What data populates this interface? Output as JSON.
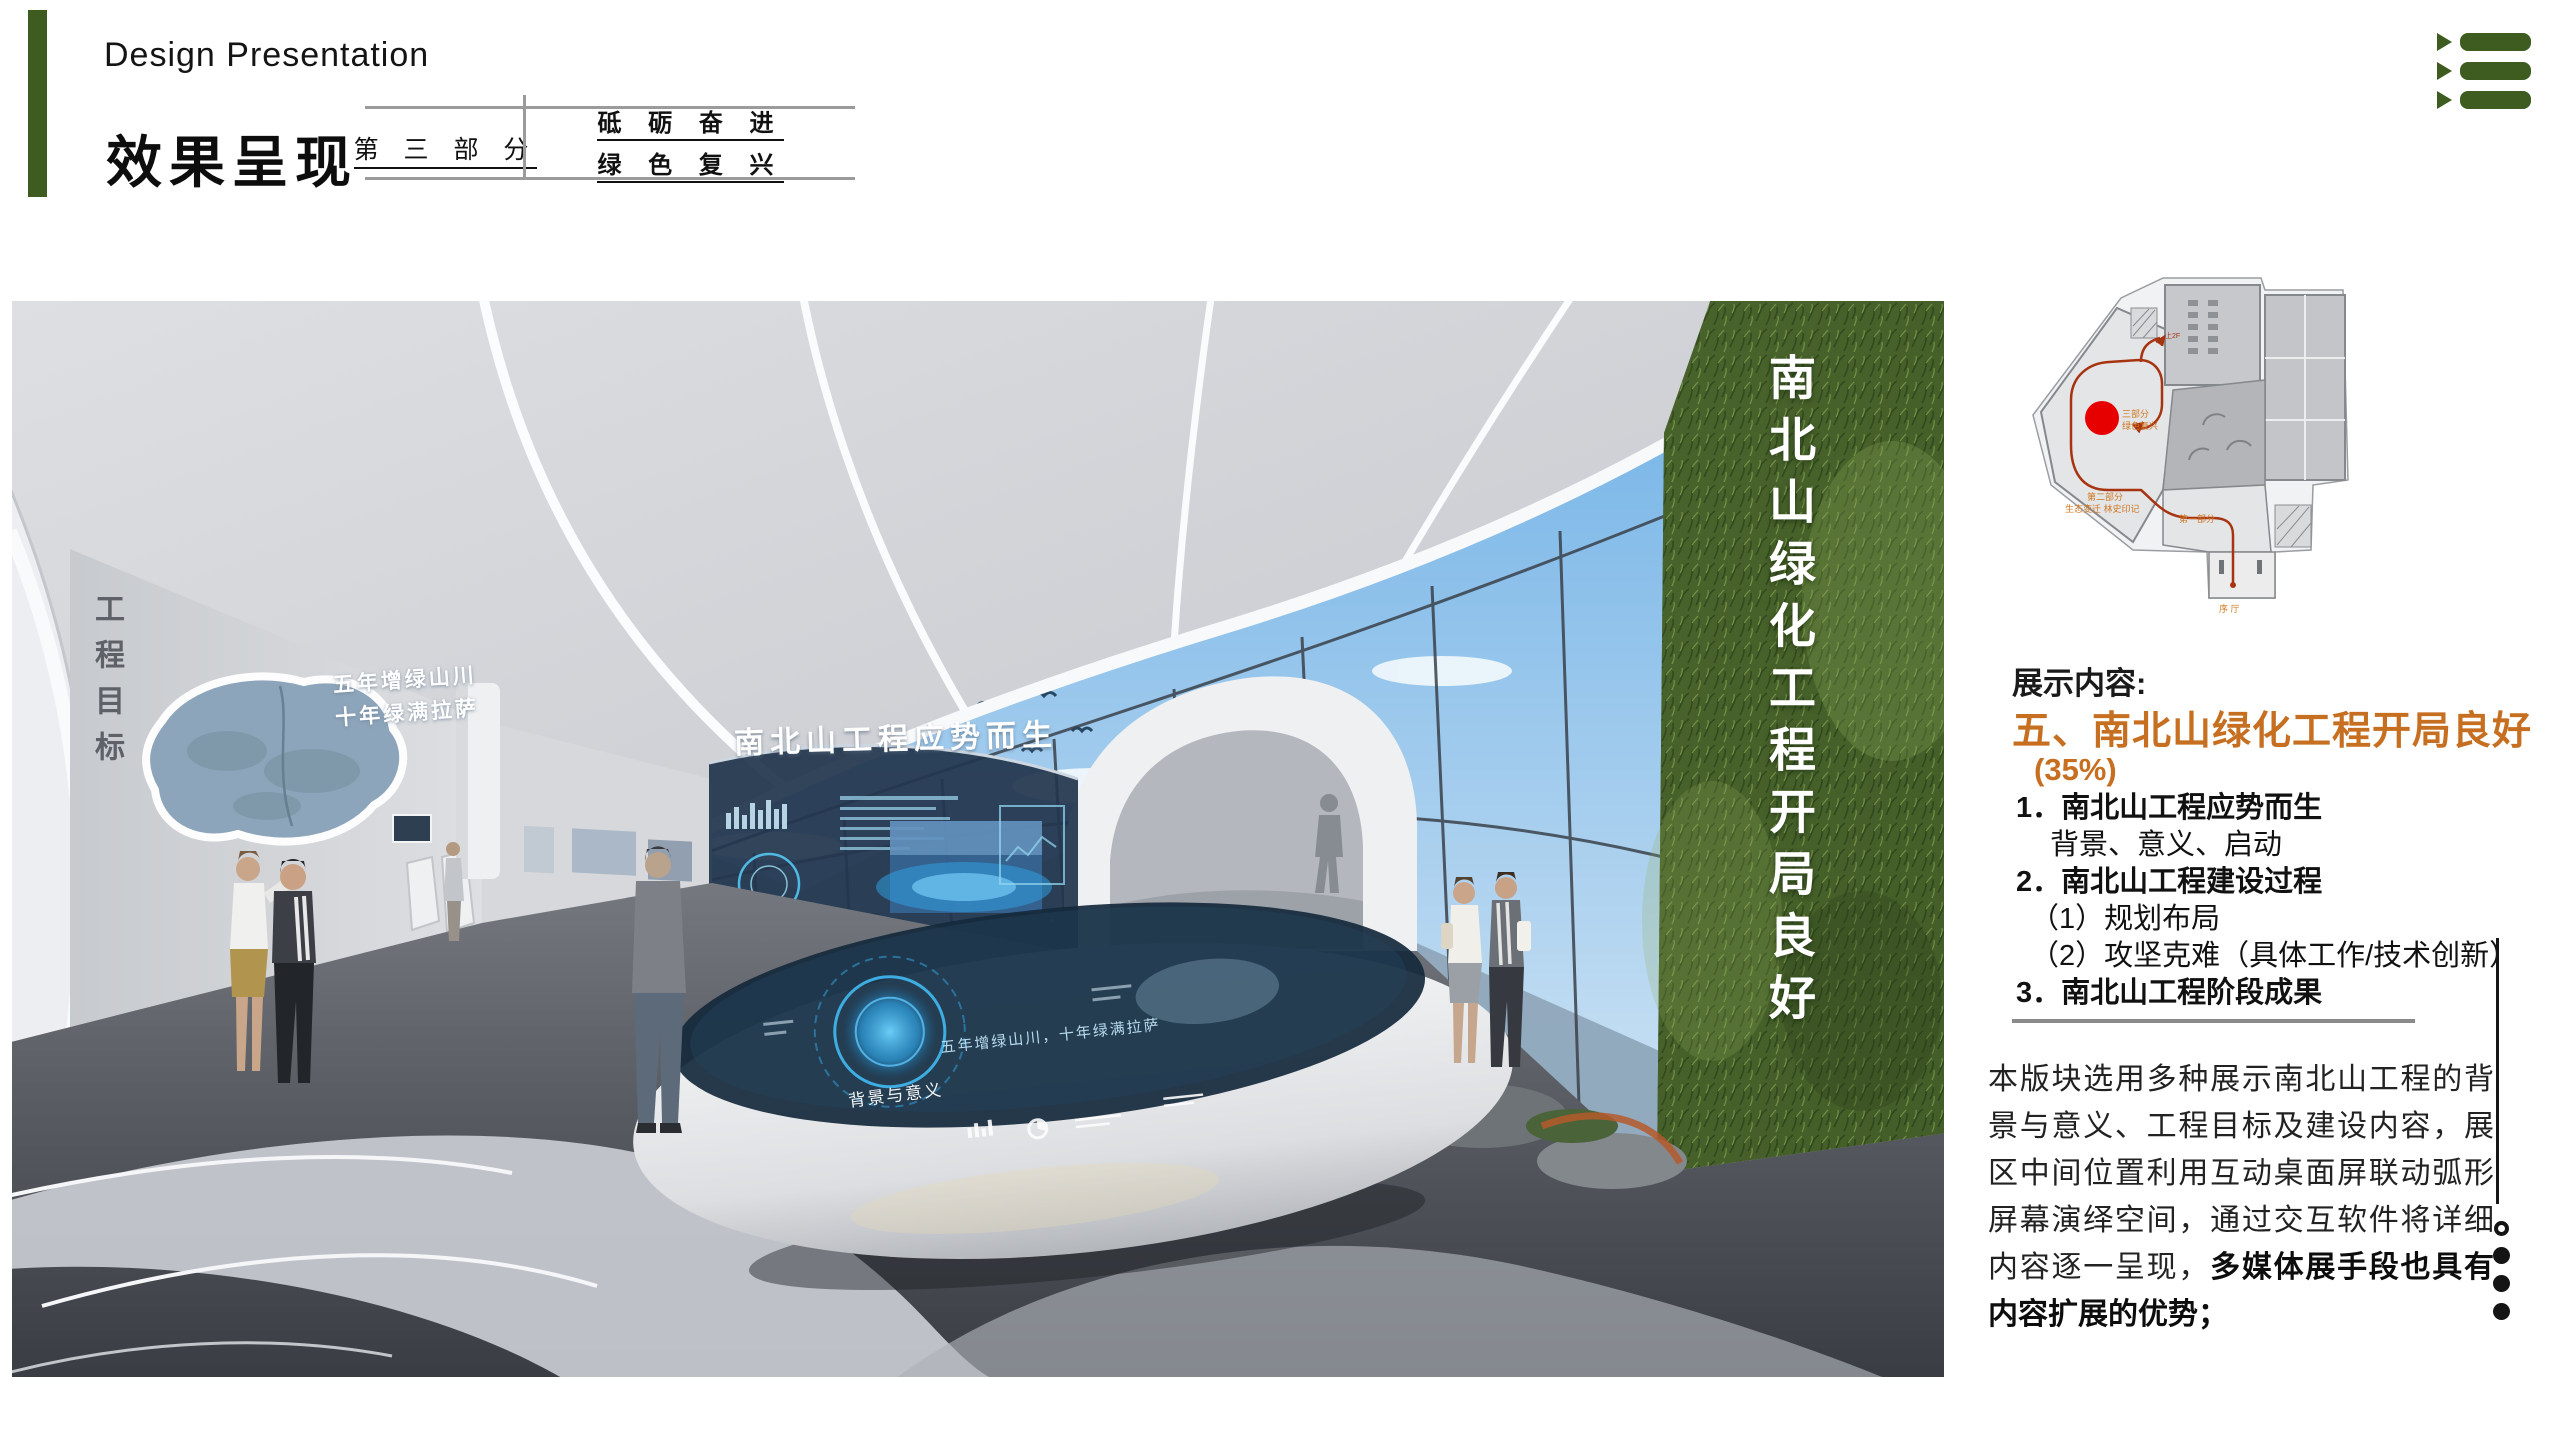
{
  "colors": {
    "accent_green": "#3E5B20",
    "accent_orange": "#C76F21",
    "marker_red": "#E60000",
    "rule_gray": "#9B9B9B"
  },
  "header": {
    "title_en": "Design Presentation",
    "title_cn": "效果呈现",
    "part_box": {
      "part_label": "第 三 部 分",
      "slogan_line1": "砥 砺 奋 进",
      "slogan_line2": "绿 色 复 兴"
    },
    "corner_icon": "triple-arrow-list-icon"
  },
  "scene": {
    "wall_goal_vertical": "工程目标",
    "map_slogan_line1": "五年增绿山川",
    "map_slogan_line2": "十年绿满拉萨",
    "screen_title": "南北山工程应势而生",
    "green_wall_title_vertical": "南北山绿化工程开局良好",
    "table_rim_label": "背景与意义",
    "table_glass_text": "五年增绿山川，十年绿满拉萨"
  },
  "floor_plan": {
    "labels": {
      "part3_line1": "三部分",
      "part3_line2": "绿色复兴",
      "part2_line1": "第二部分",
      "part2_line2": "生态变迁 林史印记",
      "part1": "第一部分",
      "lobby": "序 厅",
      "stairs": "上2F"
    }
  },
  "content": {
    "section_label": "展示内容:",
    "heading": "五、南北山绿化工程开局良好",
    "percentage": "(35%)",
    "outline": [
      {
        "text": "1．南北山工程应势而生"
      },
      {
        "text": "背景、意义、启动"
      },
      {
        "text": "2．南北山工程建设过程"
      },
      {
        "text": "（1）规划布局"
      },
      {
        "text": "（2）攻坚克难（具体工作/技术创新）"
      },
      {
        "text": "3．南北山工程阶段成果"
      }
    ],
    "paragraph_normal": "本版块选用多种展示南北山工程的背景与意义、工程目标及建设内容，展区中间位置利用互动桌面屏联动弧形屏幕演绎空间，通过交互软件将详细内容逐一呈现，",
    "paragraph_bold": "多媒体展手段也具有内容扩展的优势；"
  },
  "pagination": {
    "total": 4,
    "active_index": 0
  }
}
